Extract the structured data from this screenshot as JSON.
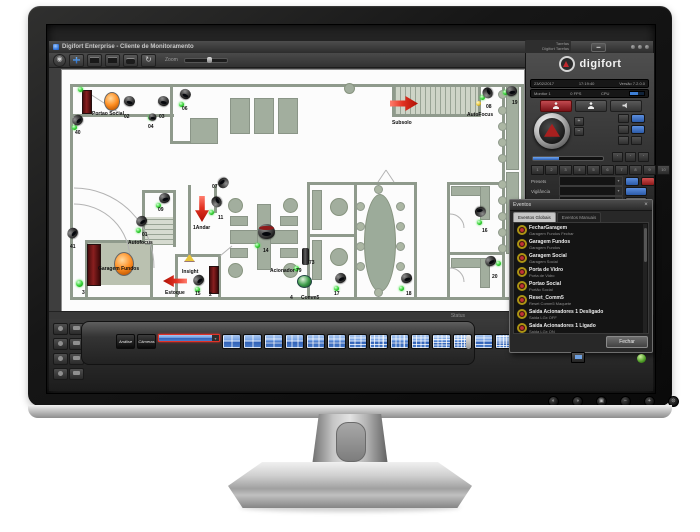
{
  "window": {
    "title": "Digifort Enterprise - Cliente de Monitoramento"
  },
  "toolbar": {
    "zoom_label": "Zoom"
  },
  "side_tabs": {
    "line1": "Tarefas",
    "line2": "Digifort Tarefas"
  },
  "brand": {
    "logo_text": "digifort",
    "date": "23/02/2017",
    "time": "17:19:40",
    "version": "Versão 7.2.0.0",
    "monitor": "Monitor 1",
    "fps": "0 FPS",
    "cpu": "CPU"
  },
  "ptz": {
    "presets_label": "Presets",
    "vigilancia_label": "Vigilância",
    "avulso_label": "Avulso",
    "preset_numbers": [
      "1",
      "2",
      "3",
      "4",
      "5",
      "6",
      "7",
      "8",
      "9",
      "10"
    ]
  },
  "panel": {
    "tab_objetos": "Objetos",
    "tab_monitores": "Monitores",
    "radio_objetos": "Objetos",
    "radio_servidores": "Servidores"
  },
  "status_bar": {
    "label": "Status"
  },
  "events": {
    "title": "Eventos",
    "tab_global": "Eventos Globais",
    "tab_manual": "Eventos Manuais",
    "close_label": "Fechar",
    "items": [
      {
        "name": "FecharGaragem",
        "desc": "Garagem Fundos Fechar"
      },
      {
        "name": "Garagem Fundos",
        "desc": "Garagem Fundos"
      },
      {
        "name": "Garagem Social",
        "desc": "Garagem Social"
      },
      {
        "name": "Porta de Vidro",
        "desc": "Porta de Vidro"
      },
      {
        "name": "Portao Social",
        "desc": "Portão Social"
      },
      {
        "name": "Reset_Comm5",
        "desc": "Reset Comm5 Maquete"
      },
      {
        "name": "Saida Acionadores 1 Desligado",
        "desc": "Saida LGx OFF"
      },
      {
        "name": "Saida Acionadores 1 Ligado",
        "desc": "Saida LGx ON"
      }
    ]
  },
  "thumbnails": [
    {
      "kind": "text",
      "label": "Análise"
    },
    {
      "kind": "text",
      "label": "Câmeras"
    },
    {
      "kind": "grid",
      "g": "1x1",
      "selected": true
    },
    {
      "kind": "grid",
      "g": "2x2"
    },
    {
      "kind": "grid",
      "g": "2x2"
    },
    {
      "kind": "grid",
      "g": "3x2"
    },
    {
      "kind": "grid",
      "g": "2x3"
    },
    {
      "kind": "grid",
      "g": "3x3"
    },
    {
      "kind": "grid",
      "g": "3x3"
    },
    {
      "kind": "grid",
      "g": "4x3"
    },
    {
      "kind": "grid",
      "g": "4x4"
    },
    {
      "kind": "grid",
      "g": "3x4"
    },
    {
      "kind": "grid",
      "g": "4x4"
    },
    {
      "kind": "grid",
      "g": "5x4"
    },
    {
      "kind": "grid",
      "g": "5x5"
    },
    {
      "kind": "grid",
      "g": "4x2"
    },
    {
      "kind": "grid",
      "g": "6x5"
    }
  ],
  "monitor_buttons": [
    {
      "name": "picture-mode",
      "glyph": "◐"
    },
    {
      "name": "input-source",
      "glyph": "◑"
    },
    {
      "name": "menu",
      "glyph": "▣"
    },
    {
      "name": "minus",
      "glyph": "−"
    },
    {
      "name": "plus",
      "glyph": "+"
    },
    {
      "name": "power",
      "glyph": "⊙"
    }
  ],
  "map": {
    "walls": [
      [
        8,
        14,
        452,
        3
      ],
      [
        8,
        14,
        3,
        216
      ],
      [
        8,
        227,
        452,
        3
      ],
      [
        440,
        14,
        3,
        216
      ],
      [
        459,
        14,
        3,
        216
      ],
      [
        8,
        44,
        104,
        3
      ],
      [
        108,
        14,
        3,
        60
      ],
      [
        108,
        71,
        32,
        3
      ],
      [
        330,
        17,
        3,
        30
      ],
      [
        330,
        44,
        88,
        3
      ],
      [
        416,
        17,
        3,
        30
      ],
      [
        126,
        115,
        3,
        69
      ],
      [
        152,
        115,
        3,
        28
      ],
      [
        113,
        184,
        46,
        3
      ],
      [
        113,
        184,
        3,
        43
      ],
      [
        156,
        184,
        3,
        43
      ],
      [
        23,
        170,
        68,
        3
      ],
      [
        23,
        170,
        3,
        57
      ],
      [
        88,
        170,
        3,
        57
      ],
      [
        245,
        112,
        110,
        3
      ],
      [
        385,
        112,
        55,
        3
      ],
      [
        245,
        112,
        3,
        115
      ],
      [
        292,
        112,
        3,
        115
      ],
      [
        352,
        112,
        3,
        115
      ],
      [
        245,
        164,
        47,
        3
      ],
      [
        385,
        112,
        3,
        115
      ],
      [
        385,
        182,
        55,
        3
      ],
      [
        80,
        120,
        31,
        3
      ],
      [
        80,
        120,
        3,
        57
      ],
      [
        111,
        120,
        3,
        57
      ]
    ],
    "furniture": [
      [
        168,
        28,
        18,
        34
      ],
      [
        192,
        28,
        18,
        34
      ],
      [
        216,
        28,
        18,
        34
      ],
      [
        128,
        48,
        26,
        24
      ],
      [
        168,
        160,
        66,
        12
      ],
      [
        195,
        134,
        12,
        64
      ],
      [
        168,
        146,
        16,
        8
      ],
      [
        218,
        146,
        16,
        8
      ],
      [
        168,
        178,
        16,
        8
      ],
      [
        218,
        178,
        16,
        8
      ],
      [
        250,
        120,
        8,
        38
      ],
      [
        250,
        170,
        8,
        38
      ],
      [
        389,
        116,
        28,
        8
      ],
      [
        418,
        116,
        8,
        32
      ],
      [
        389,
        188,
        28,
        8
      ],
      [
        418,
        188,
        8,
        28
      ],
      [
        444,
        16,
        11,
        82
      ],
      [
        444,
        102,
        11,
        80
      ]
    ],
    "round_tables": [
      [
        166,
        128,
        13
      ],
      [
        221,
        128,
        13
      ],
      [
        166,
        193,
        13
      ],
      [
        221,
        193,
        13
      ],
      [
        268,
        128,
        16
      ],
      [
        268,
        178,
        16
      ],
      [
        282,
        13,
        9
      ]
    ],
    "oval_tables": [
      [
        302,
        124,
        30,
        96
      ]
    ],
    "chairs": [
      [
        294,
        132
      ],
      [
        294,
        152
      ],
      [
        294,
        172
      ],
      [
        294,
        192
      ],
      [
        334,
        132
      ],
      [
        334,
        152
      ],
      [
        334,
        172
      ],
      [
        334,
        192
      ],
      [
        312,
        115
      ],
      [
        312,
        218
      ],
      [
        436,
        20
      ],
      [
        436,
        36
      ],
      [
        436,
        52
      ],
      [
        436,
        68
      ],
      [
        436,
        84
      ],
      [
        436,
        110
      ],
      [
        436,
        126
      ],
      [
        436,
        142
      ],
      [
        436,
        158
      ],
      [
        436,
        174
      ]
    ],
    "fills": [
      {
        "x": 26,
        "y": 173,
        "w": 62,
        "h": 42,
        "kind": "room"
      },
      {
        "x": 333,
        "y": 17,
        "w": 83,
        "h": 27,
        "kind": "stairs-h"
      },
      {
        "x": 83,
        "y": 147,
        "w": 28,
        "h": 28,
        "kind": "stairs-v"
      }
    ],
    "doors": [
      [
        20,
        20,
        8,
        22
      ],
      [
        25,
        174,
        12,
        40
      ],
      [
        147,
        196,
        8,
        26
      ]
    ],
    "lights": [
      [
        42,
        22,
        14,
        17
      ],
      [
        52,
        182,
        18,
        22
      ]
    ],
    "lamps": [
      [
        122,
        184
      ]
    ],
    "cylinders": [
      [
        240,
        178
      ]
    ],
    "green_domes": [
      [
        235,
        205
      ]
    ],
    "arrows": [
      {
        "dir": "down",
        "x": 133,
        "y": 126,
        "w": 14,
        "h": 26
      },
      {
        "dir": "left",
        "x": 101,
        "y": 205,
        "w": 24,
        "h": 12
      },
      {
        "dir": "right",
        "x": 328,
        "y": 26,
        "w": 28,
        "h": 15
      }
    ],
    "dots": [
      {
        "x": 16,
        "y": 17
      },
      {
        "x": 86,
        "y": 45
      },
      {
        "x": 117,
        "y": 32
      },
      {
        "x": 10,
        "y": 55
      },
      {
        "x": 418,
        "y": 25
      },
      {
        "x": 414,
        "y": 31,
        "c": "yellow"
      },
      {
        "x": 441,
        "y": 20
      },
      {
        "x": 94,
        "y": 133
      },
      {
        "x": 147,
        "y": 140
      },
      {
        "x": 193,
        "y": 173
      },
      {
        "x": 133,
        "y": 217
      },
      {
        "x": 74,
        "y": 158
      },
      {
        "x": 14,
        "y": 210,
        "big": true
      },
      {
        "x": 272,
        "y": 216
      },
      {
        "x": 337,
        "y": 216
      },
      {
        "x": 415,
        "y": 150
      },
      {
        "x": 434,
        "y": 191
      },
      {
        "x": 232,
        "y": 196
      }
    ],
    "cameras": [
      {
        "id": "02",
        "x": 62,
        "y": 26,
        "r": 15
      },
      {
        "id": "40",
        "x": 10,
        "y": 45,
        "r": -45
      },
      {
        "id": "03",
        "x": 96,
        "y": 26,
        "r": 10
      },
      {
        "id": "04",
        "x": 85,
        "y": 42,
        "r": 0,
        "s": "small"
      },
      {
        "id": "06",
        "x": 118,
        "y": 19,
        "r": 25
      },
      {
        "id": "08",
        "x": 420,
        "y": 18,
        "r": -115
      },
      {
        "id": "19",
        "x": 444,
        "y": 16,
        "r": -10
      },
      {
        "id": "09",
        "x": 97,
        "y": 123,
        "r": -15
      },
      {
        "id": "07",
        "x": 156,
        "y": 108,
        "r": 140
      },
      {
        "id": "11",
        "x": 149,
        "y": 127,
        "r": -120
      },
      {
        "id": "14",
        "x": 196,
        "y": 154,
        "r": 0,
        "s": "big"
      },
      {
        "id": "01",
        "x": 74,
        "y": 146,
        "r": -35
      },
      {
        "id": "41",
        "x": 5,
        "y": 158,
        "r": -50
      },
      {
        "id": "15",
        "x": 131,
        "y": 205,
        "r": -40
      },
      {
        "id": "17",
        "x": 273,
        "y": 203,
        "r": -25
      },
      {
        "id": "18",
        "x": 339,
        "y": 203,
        "r": -15
      },
      {
        "id": "16",
        "x": 413,
        "y": 137,
        "r": 170
      },
      {
        "id": "20",
        "x": 423,
        "y": 186,
        "r": -30
      }
    ],
    "labels": [
      {
        "t": "Portao Social",
        "x": 30,
        "y": 41
      },
      {
        "t": "02",
        "x": 62,
        "y": 44
      },
      {
        "t": "40",
        "x": 13,
        "y": 60
      },
      {
        "t": "03",
        "x": 97,
        "y": 44
      },
      {
        "t": "04",
        "x": 86,
        "y": 54
      },
      {
        "t": "06",
        "x": 120,
        "y": 36
      },
      {
        "t": "Subsolo",
        "x": 330,
        "y": 50
      },
      {
        "t": "AutoFocus",
        "x": 405,
        "y": 42
      },
      {
        "t": "08",
        "x": 424,
        "y": 34
      },
      {
        "t": "19",
        "x": 450,
        "y": 30
      },
      {
        "t": "09",
        "x": 96,
        "y": 137
      },
      {
        "t": "07",
        "x": 150,
        "y": 114
      },
      {
        "t": "11",
        "x": 156,
        "y": 145
      },
      {
        "t": "1Andar",
        "x": 131,
        "y": 155
      },
      {
        "t": "14",
        "x": 201,
        "y": 178
      },
      {
        "t": "Insight",
        "x": 120,
        "y": 199
      },
      {
        "t": "15",
        "x": 133,
        "y": 221
      },
      {
        "t": "2",
        "x": 147,
        "y": 222
      },
      {
        "t": "Estoque",
        "x": 103,
        "y": 220
      },
      {
        "t": "Autofocus",
        "x": 66,
        "y": 170
      },
      {
        "t": "01",
        "x": 80,
        "y": 162
      },
      {
        "t": "Garagem Fundos",
        "x": 36,
        "y": 196
      },
      {
        "t": "41",
        "x": 8,
        "y": 174
      },
      {
        "t": "3",
        "x": 20,
        "y": 220
      },
      {
        "t": "Acionador",
        "x": 208,
        "y": 198
      },
      {
        "t": "79",
        "x": 234,
        "y": 198
      },
      {
        "t": "73",
        "x": 247,
        "y": 190
      },
      {
        "t": "4",
        "x": 228,
        "y": 225
      },
      {
        "t": "Comm5",
        "x": 239,
        "y": 225
      },
      {
        "t": "17",
        "x": 272,
        "y": 221
      },
      {
        "t": "18",
        "x": 344,
        "y": 221
      },
      {
        "t": "16",
        "x": 420,
        "y": 158
      },
      {
        "t": "20",
        "x": 430,
        "y": 204
      }
    ]
  }
}
